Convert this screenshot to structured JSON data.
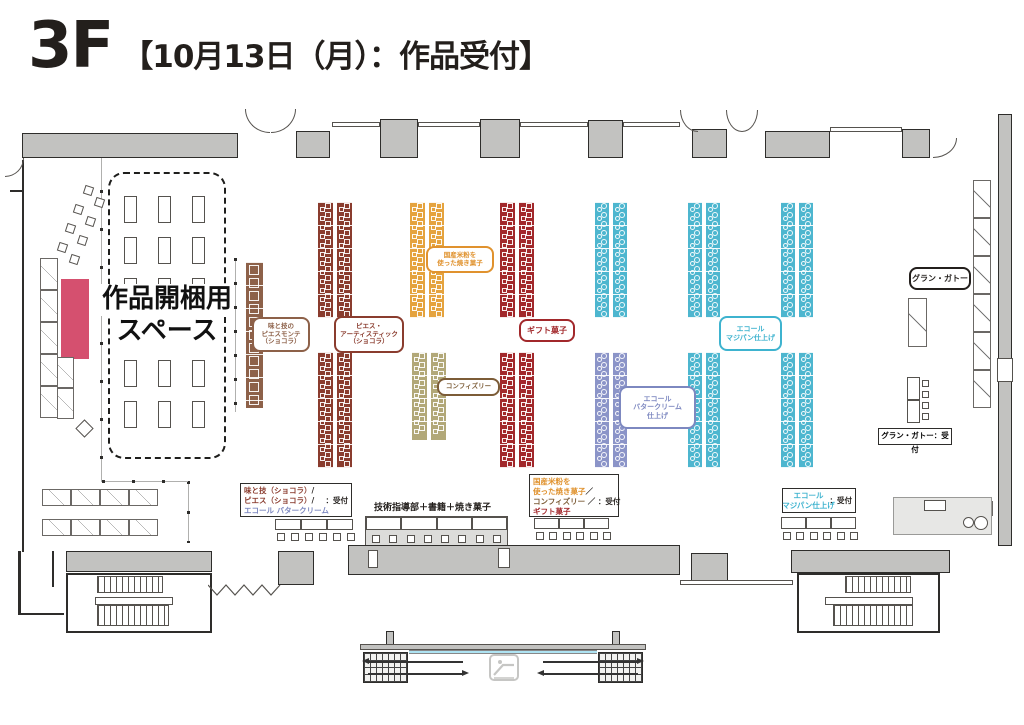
{
  "title": {
    "floor": "3F",
    "subtitle": "【10月13日（月）：作品受付】"
  },
  "unpacking_area": {
    "line1": "作品開梱用",
    "line2": "スペース"
  },
  "tech_counter_label": "技術指導部＋書籍＋焼き菓子",
  "grand_gateau_reception_label": "グラン・ガトー：受付",
  "colors": {
    "ink": "#231f1c",
    "maroon": "#8a3c2e",
    "brown": "#8d6149",
    "orange": "#e0922e",
    "tanbrown": "#7c5c37",
    "red": "#a2282b",
    "periwinkle": "#7d88c0",
    "cyan": "#3eb3cf",
    "orangeStrip": "#e5a33e",
    "tanStrip": "#b2a878",
    "redStrip": "#a2282b",
    "cyanStrip": "#4db6cf",
    "purpleStrip": "#8b94c8",
    "crimson": "#d5506f",
    "wall": "#c2c2c0",
    "glass": "#aee3f2"
  },
  "booth_labels": [
    {
      "n": "aji-to-waza-piecemontee",
      "x": 252,
      "y": 317,
      "w": 58,
      "h": 35,
      "c": "brown",
      "fs": 6.5,
      "lines": [
        "味と技の",
        "ピエスモンテ",
        "（ショコラ）"
      ]
    },
    {
      "n": "piece-artistique",
      "x": 334,
      "y": 316,
      "w": 70,
      "h": 37,
      "c": "maroon",
      "fs": 6.5,
      "lines": [
        "ピエス・",
        "アーティスティック",
        "（ショコラ）"
      ]
    },
    {
      "n": "kokusan-komeko",
      "x": 426,
      "y": 246,
      "w": 68,
      "h": 27,
      "c": "orange",
      "fs": 6.5,
      "lines": [
        "国産米粉を",
        "使った焼き菓子"
      ]
    },
    {
      "n": "confiserie",
      "x": 437,
      "y": 378,
      "w": 63,
      "h": 18,
      "c": "tanbrown",
      "fs": 6.5,
      "lines": [
        "コンフィズリー"
      ]
    },
    {
      "n": "gift-kashi",
      "x": 519,
      "y": 319,
      "w": 56,
      "h": 23,
      "c": "red",
      "fs": 8,
      "lines": [
        "ギフト菓子"
      ]
    },
    {
      "n": "ecole-buttercream",
      "x": 619,
      "y": 386,
      "w": 77,
      "h": 43,
      "c": "periwinkle",
      "fs": 7,
      "lines": [
        "エコール",
        "バタークリーム",
        "仕上げ"
      ]
    },
    {
      "n": "ecole-marzipan",
      "x": 719,
      "y": 316,
      "w": 63,
      "h": 35,
      "c": "cyan",
      "fs": 7,
      "lines": [
        "エコール",
        "マジパン仕上げ"
      ]
    },
    {
      "n": "grand-gateau",
      "x": 909,
      "y": 267,
      "w": 62,
      "h": 23,
      "c": "ink",
      "fs": 8,
      "lines": [
        "グラン・ガトー"
      ]
    }
  ],
  "booth_strips": [
    [
      246,
      262,
      17,
      146,
      "brown",
      "b"
    ],
    [
      318,
      202,
      15,
      116,
      "maroon",
      "s"
    ],
    [
      337,
      202,
      15,
      116,
      "maroon",
      "s"
    ],
    [
      318,
      352,
      15,
      116,
      "maroon",
      "s"
    ],
    [
      337,
      352,
      15,
      116,
      "maroon",
      "s"
    ],
    [
      410,
      202,
      15,
      116,
      "orangeStrip",
      "s"
    ],
    [
      429,
      202,
      15,
      116,
      "orangeStrip",
      "s"
    ],
    [
      412,
      352,
      15,
      88,
      "tanStrip",
      "s"
    ],
    [
      431,
      352,
      15,
      88,
      "tanStrip",
      "s"
    ],
    [
      500,
      202,
      15,
      116,
      "redStrip",
      "s"
    ],
    [
      519,
      202,
      15,
      116,
      "redStrip",
      "s"
    ],
    [
      500,
      352,
      15,
      116,
      "redStrip",
      "s"
    ],
    [
      519,
      352,
      15,
      116,
      "redStrip",
      "s"
    ],
    [
      595,
      202,
      14,
      116,
      "cyanStrip",
      "c"
    ],
    [
      613,
      202,
      14,
      116,
      "cyanStrip",
      "c"
    ],
    [
      595,
      352,
      14,
      116,
      "purpleStrip",
      "c"
    ],
    [
      613,
      352,
      14,
      116,
      "purpleStrip",
      "c"
    ],
    [
      688,
      202,
      14,
      116,
      "cyanStrip",
      "c"
    ],
    [
      706,
      202,
      14,
      116,
      "cyanStrip",
      "c"
    ],
    [
      688,
      352,
      14,
      116,
      "cyanStrip",
      "c"
    ],
    [
      706,
      352,
      14,
      116,
      "cyanStrip",
      "c"
    ],
    [
      781,
      202,
      14,
      116,
      "cyanStrip",
      "c"
    ],
    [
      799,
      202,
      14,
      116,
      "cyanStrip",
      "c"
    ],
    [
      781,
      352,
      14,
      116,
      "cyanStrip",
      "c"
    ],
    [
      799,
      352,
      14,
      116,
      "cyanStrip",
      "c"
    ]
  ],
  "reception_boxes": [
    {
      "n": "reception-chocolat-buttercream",
      "x": 240,
      "y": 483,
      "w": 112,
      "h": 34,
      "rows": [
        [
          {
            "t": "味と技（ショコラ）",
            "c": "maroon"
          },
          {
            "t": "/",
            "c": "ink"
          }
        ],
        [
          {
            "t": "ピエス（ショコラ）",
            "c": "maroon"
          },
          {
            "t": "/",
            "c": "ink"
          },
          {
            "t": "：受付",
            "c": "ink",
            "right": true
          }
        ],
        [
          {
            "t": "エコール バタークリーム",
            "c": "periwinkle"
          }
        ]
      ]
    },
    {
      "n": "reception-komeko-confiserie-gift",
      "x": 529,
      "y": 474,
      "w": 90,
      "h": 43,
      "rows": [
        [
          {
            "t": "国産米粉を",
            "c": "orange"
          }
        ],
        [
          {
            "t": "使った焼き菓子",
            "c": "orange"
          },
          {
            "t": "／",
            "c": "ink"
          }
        ],
        [
          {
            "t": "コンフィズリー",
            "c": "tanbrown"
          },
          {
            "t": " ／ ",
            "c": "ink"
          },
          {
            "t": "：受付",
            "c": "ink",
            "right": true
          }
        ],
        [
          {
            "t": "ギフト菓子",
            "c": "red"
          }
        ]
      ]
    },
    {
      "n": "reception-ecole-marzipan",
      "x": 782,
      "y": 488,
      "w": 74,
      "h": 25,
      "center": true,
      "right_center": {
        "t": "：受付",
        "c": "ink"
      },
      "rows": [
        [
          {
            "t": "エコール",
            "c": "cyan"
          }
        ],
        [
          {
            "t": "マジパン仕上げ",
            "c": "cyan"
          }
        ]
      ]
    }
  ],
  "reception_tables": [
    {
      "x": 275,
      "y": 519,
      "tables": 3,
      "tw": 26,
      "th": 11,
      "chairs": 6,
      "cy": 533
    },
    {
      "x": 534,
      "y": 518,
      "tables": 3,
      "tw": 25,
      "th": 11,
      "chairs": 6,
      "cy": 532
    },
    {
      "x": 781,
      "y": 517,
      "tables": 3,
      "tw": 25,
      "th": 12,
      "chairs": 6,
      "cy": 532
    }
  ],
  "tech_block": {
    "x": 365,
    "y": 516,
    "w": 143,
    "h": 31,
    "tables": 4,
    "chairs": 8,
    "label_x": 374,
    "label_y": 500
  },
  "grand_reception": {
    "table": [
      907,
      377,
      13,
      46
    ],
    "chairs": [
      [
        922,
        380
      ],
      [
        922,
        391
      ],
      [
        922,
        402
      ],
      [
        922,
        413
      ]
    ],
    "label_box": {
      "x": 878,
      "y": 428,
      "w": 74,
      "h": 17,
      "fs": 7.5
    }
  },
  "floorplan": {
    "walls": [
      [
        22,
        133,
        216,
        25
      ],
      [
        296,
        131,
        34,
        27
      ],
      [
        380,
        119,
        38,
        39
      ],
      [
        480,
        119,
        40,
        39
      ],
      [
        588,
        120,
        35,
        38
      ],
      [
        692,
        129,
        35,
        29
      ],
      [
        765,
        131,
        65,
        27
      ],
      [
        902,
        129,
        28,
        29
      ],
      [
        998,
        114,
        14,
        432
      ],
      [
        66,
        551,
        146,
        21
      ],
      [
        278,
        551,
        36,
        34
      ],
      [
        348,
        545,
        332,
        30
      ],
      [
        691,
        553,
        37,
        32
      ],
      [
        791,
        550,
        159,
        23
      ],
      [
        386,
        631,
        8,
        14
      ],
      [
        612,
        631,
        8,
        14
      ]
    ],
    "thin_walls": [
      [
        332,
        122,
        48,
        5
      ],
      [
        418,
        122,
        62,
        5
      ],
      [
        520,
        122,
        68,
        5
      ],
      [
        623,
        122,
        57,
        5
      ],
      [
        830,
        127,
        72,
        5
      ],
      [
        680,
        580,
        113,
        5
      ]
    ],
    "lines": [
      [
        22,
        160,
        2,
        392
      ],
      [
        18,
        551,
        3,
        64
      ],
      [
        18,
        613,
        46,
        2
      ],
      [
        52,
        551,
        2,
        36
      ],
      [
        10,
        190,
        12,
        2
      ]
    ],
    "slits": [
      [
        368,
        550,
        10,
        18
      ],
      [
        498,
        548,
        12,
        20
      ],
      [
        997,
        358,
        16,
        24
      ]
    ],
    "dotted_v": [
      [
        100,
        152,
        330,
        38
      ],
      [
        187,
        481,
        62,
        30
      ],
      [
        234,
        258,
        154,
        24
      ]
    ],
    "dotted_h": [
      [
        102,
        480,
        86
      ]
    ],
    "arcs": [
      [
        245,
        109,
        25,
        24,
        "bl"
      ],
      [
        271,
        109,
        25,
        24,
        "br"
      ],
      [
        680,
        110,
        18,
        22,
        "bl"
      ],
      [
        726,
        110,
        16,
        22,
        "bl"
      ],
      [
        742,
        110,
        16,
        22,
        "br"
      ],
      [
        933,
        138,
        24,
        20,
        "br"
      ],
      [
        5,
        158,
        19,
        19,
        "br"
      ],
      [
        68,
        606,
        20,
        26,
        "tr"
      ],
      [
        190,
        606,
        20,
        26,
        "tl"
      ],
      [
        799,
        606,
        20,
        26,
        "tr"
      ],
      [
        918,
        606,
        20,
        26,
        "tl"
      ]
    ],
    "shelves": [
      {
        "x": 40,
        "y": 258,
        "cw": 18,
        "ch": 32,
        "n": 5,
        "dir": "v"
      },
      {
        "x": 57,
        "y": 357,
        "cw": 17,
        "ch": 31,
        "n": 2,
        "dir": "v"
      },
      {
        "x": 42,
        "y": 489,
        "cw": 29,
        "ch": 17,
        "n": 4,
        "dir": "h"
      },
      {
        "x": 42,
        "y": 519,
        "cw": 29,
        "ch": 17,
        "n": 4,
        "dir": "h"
      },
      {
        "x": 973,
        "y": 180,
        "cw": 18,
        "ch": 38,
        "n": 6,
        "dir": "v"
      },
      {
        "x": 908,
        "y": 298,
        "cw": 19,
        "ch": 49,
        "n": 1,
        "dir": "v"
      },
      {
        "x": 900,
        "y": 504,
        "cw": 13,
        "ch": 24,
        "n": 1,
        "dir": "v"
      },
      {
        "x": 950,
        "y": 499,
        "cw": 24,
        "ch": 16,
        "n": 1,
        "dir": "v"
      },
      {
        "x": 976,
        "y": 501,
        "cw": 17,
        "ch": 15,
        "n": 1,
        "dir": "v"
      }
    ],
    "unpack_box": [
      108,
      172,
      118,
      287
    ],
    "inner_tables": {
      "cols": [
        124,
        158,
        192
      ],
      "rows": [
        196,
        237,
        278,
        319,
        360,
        401
      ],
      "w": 13,
      "h": 27
    },
    "crimson_rect": [
      61,
      279,
      28,
      80
    ],
    "diamond": [
      78,
      422,
      13,
      13
    ],
    "scatter_chairs": [
      [
        84,
        186
      ],
      [
        95,
        198
      ],
      [
        74,
        205
      ],
      [
        86,
        217
      ],
      [
        66,
        224
      ],
      [
        78,
        236
      ],
      [
        58,
        243
      ],
      [
        70,
        255
      ]
    ],
    "right_panel": [
      893,
      497,
      99,
      38
    ],
    "panel_rect": [
      924,
      500,
      22,
      11
    ],
    "panel_circles": [
      [
        963,
        517,
        11
      ],
      [
        974,
        516,
        14
      ]
    ],
    "stairwells": [
      {
        "outer": [
          66,
          573,
          146,
          60
        ],
        "hatch": [
          [
            97,
            576,
            66,
            17
          ],
          [
            97,
            605,
            72,
            21
          ]
        ],
        "land": [
          95,
          597,
          78,
          8
        ],
        "diag": [
          100,
          580,
          78,
          32
        ]
      },
      {
        "outer": [
          797,
          573,
          143,
          60
        ],
        "hatch": [
          [
            845,
            576,
            66,
            17
          ],
          [
            833,
            605,
            80,
            21
          ]
        ],
        "land": [
          825,
          597,
          88,
          8
        ],
        "diag": [
          830,
          580,
          78,
          32
        ]
      }
    ],
    "zigzag": {
      "x": 208,
      "y": 581,
      "w": 74,
      "h": 18
    },
    "escalator": {
      "bar": [
        360,
        644,
        286,
        6
      ],
      "glass": [
        409,
        650,
        188,
        4
      ],
      "grids": [
        [
          363,
          652,
          45,
          31
        ],
        [
          598,
          652,
          45,
          31
        ]
      ],
      "icon": [
        489,
        654,
        30,
        27
      ],
      "arrows": [
        {
          "x": 368,
          "y": 661,
          "len": 95,
          "head": "left"
        },
        {
          "x": 368,
          "y": 673,
          "len": 95,
          "head": "right"
        },
        {
          "x": 543,
          "y": 661,
          "len": 95,
          "head": "right"
        },
        {
          "x": 543,
          "y": 673,
          "len": 95,
          "head": "left"
        }
      ]
    }
  }
}
